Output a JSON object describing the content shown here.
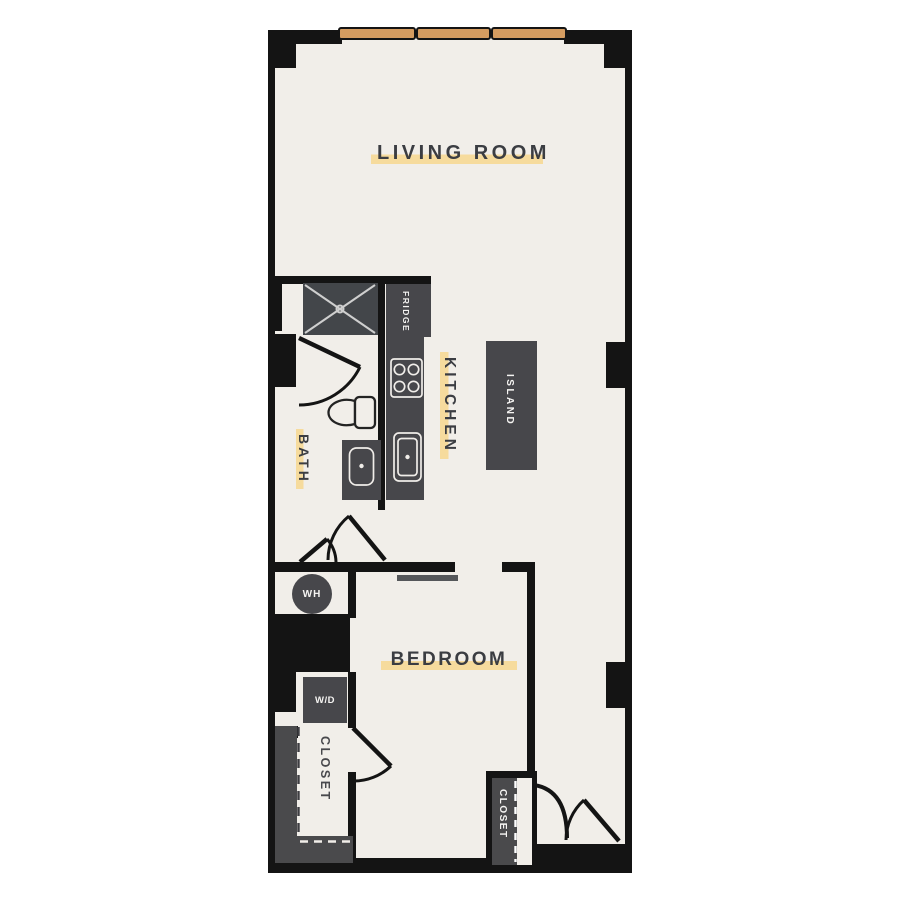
{
  "floorplan": {
    "labels": {
      "living_room": "LIVING ROOM",
      "kitchen": "KITCHEN",
      "bath": "BATH",
      "bedroom": "BEDROOM",
      "island": "ISLAND",
      "fridge": "FRIDGE",
      "water_heater": "WH",
      "washer_dryer": "W/D",
      "closet_left": "CLOSET",
      "closet_entry": "CLOSET"
    },
    "colors": {
      "floor": "#f1eee9",
      "wall": "#141414",
      "fixture_dark": "#47474b",
      "shower_fill": "#43464a",
      "closet_poche": "#4a4a4c",
      "window_orange": "#d59c60",
      "label_text": "#3b3d42",
      "highlight_yellow": "#f6db9d",
      "opening_bar": "#55575a"
    }
  }
}
